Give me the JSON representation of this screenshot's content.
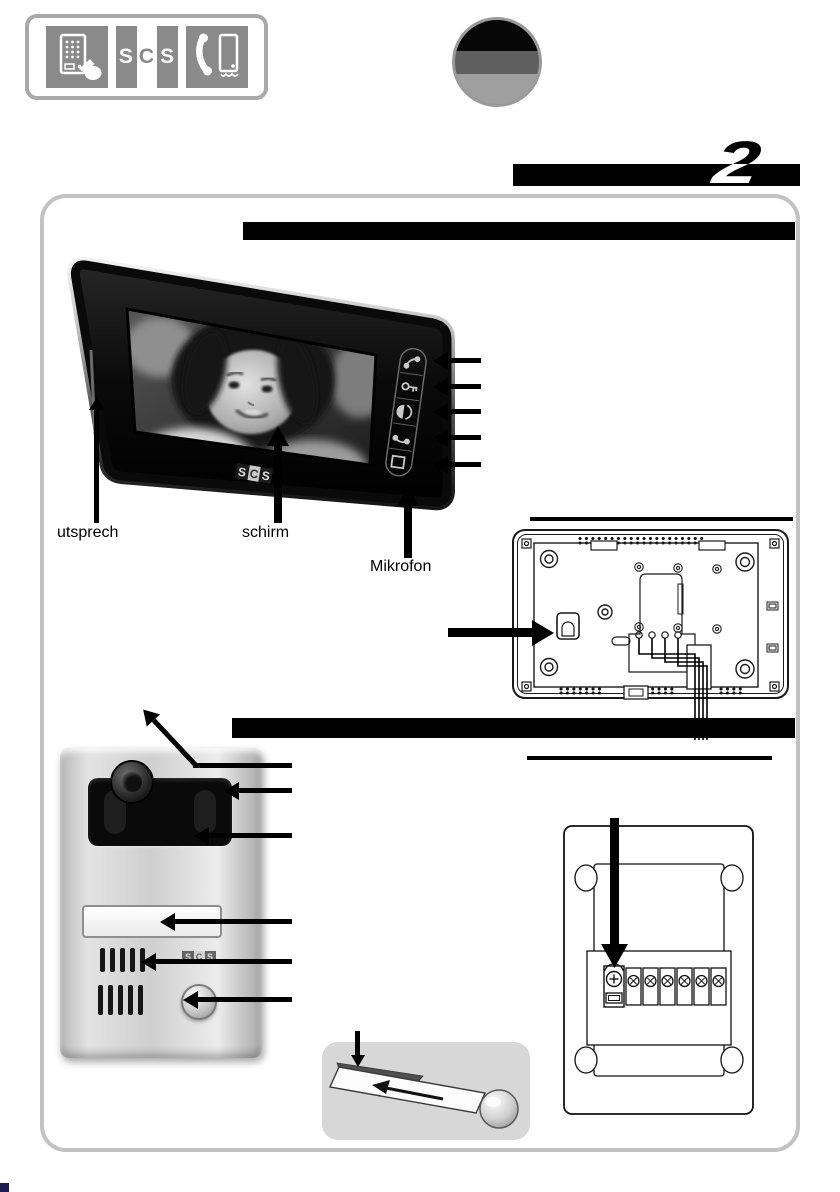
{
  "chapter": {
    "number": "2"
  },
  "brand": {
    "letters": [
      "S",
      "C",
      "S"
    ]
  },
  "callouts": {
    "speaker": "utsprech",
    "screen": "schirm",
    "microphone": "Mikrofon"
  },
  "icons": {
    "header": [
      "door-panel-hand-icon",
      "scs-logo",
      "handset-and-panel-icon"
    ],
    "flag": "germany-flag-circle",
    "monitor_buttons": [
      "handset-icon",
      "door-release-icon",
      "brightness-icon",
      "hangup-icon",
      "display-icon"
    ],
    "door_station": [
      "camera-lens",
      "ir-led-window",
      "name-label-window",
      "speaker-grille",
      "call-button"
    ]
  },
  "colors": {
    "section_bar": "#000000",
    "frame_border": "#c2c2c2",
    "tile_gray": "#8a8a8a",
    "flag_bands": [
      "#060606",
      "#5f5f5f",
      "#9f9f9f"
    ]
  }
}
